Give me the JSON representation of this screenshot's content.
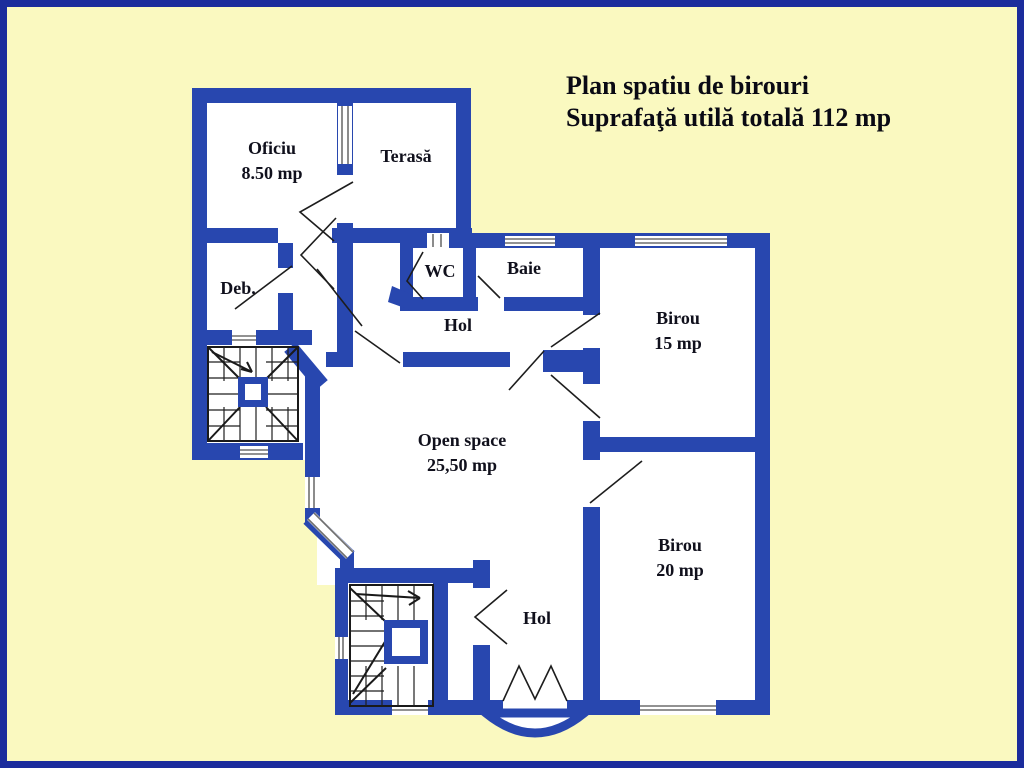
{
  "title": {
    "line1": "Plan spatiu de birouri",
    "line2": "Suprafaţă utilă totală 112 mp"
  },
  "rooms": {
    "oficiu": {
      "name": "Oficiu",
      "area": "8.50 mp"
    },
    "terasa": {
      "name": "Terasă"
    },
    "debara": {
      "name": "Deb."
    },
    "wc": {
      "name": "WC"
    },
    "baie": {
      "name": "Baie"
    },
    "hol_upper": {
      "name": "Hol"
    },
    "birou_15": {
      "name": "Birou",
      "area": "15 mp"
    },
    "open_space": {
      "name": "Open space",
      "area": "25,50 mp"
    },
    "birou_20": {
      "name": "Birou",
      "area": "20 mp"
    },
    "hol_lower": {
      "name": "Hol"
    }
  },
  "colors": {
    "background": "#FAF9C0",
    "frame": "#1B2C9C",
    "wall": "#2847AF",
    "floor": "#FFFFFF"
  }
}
